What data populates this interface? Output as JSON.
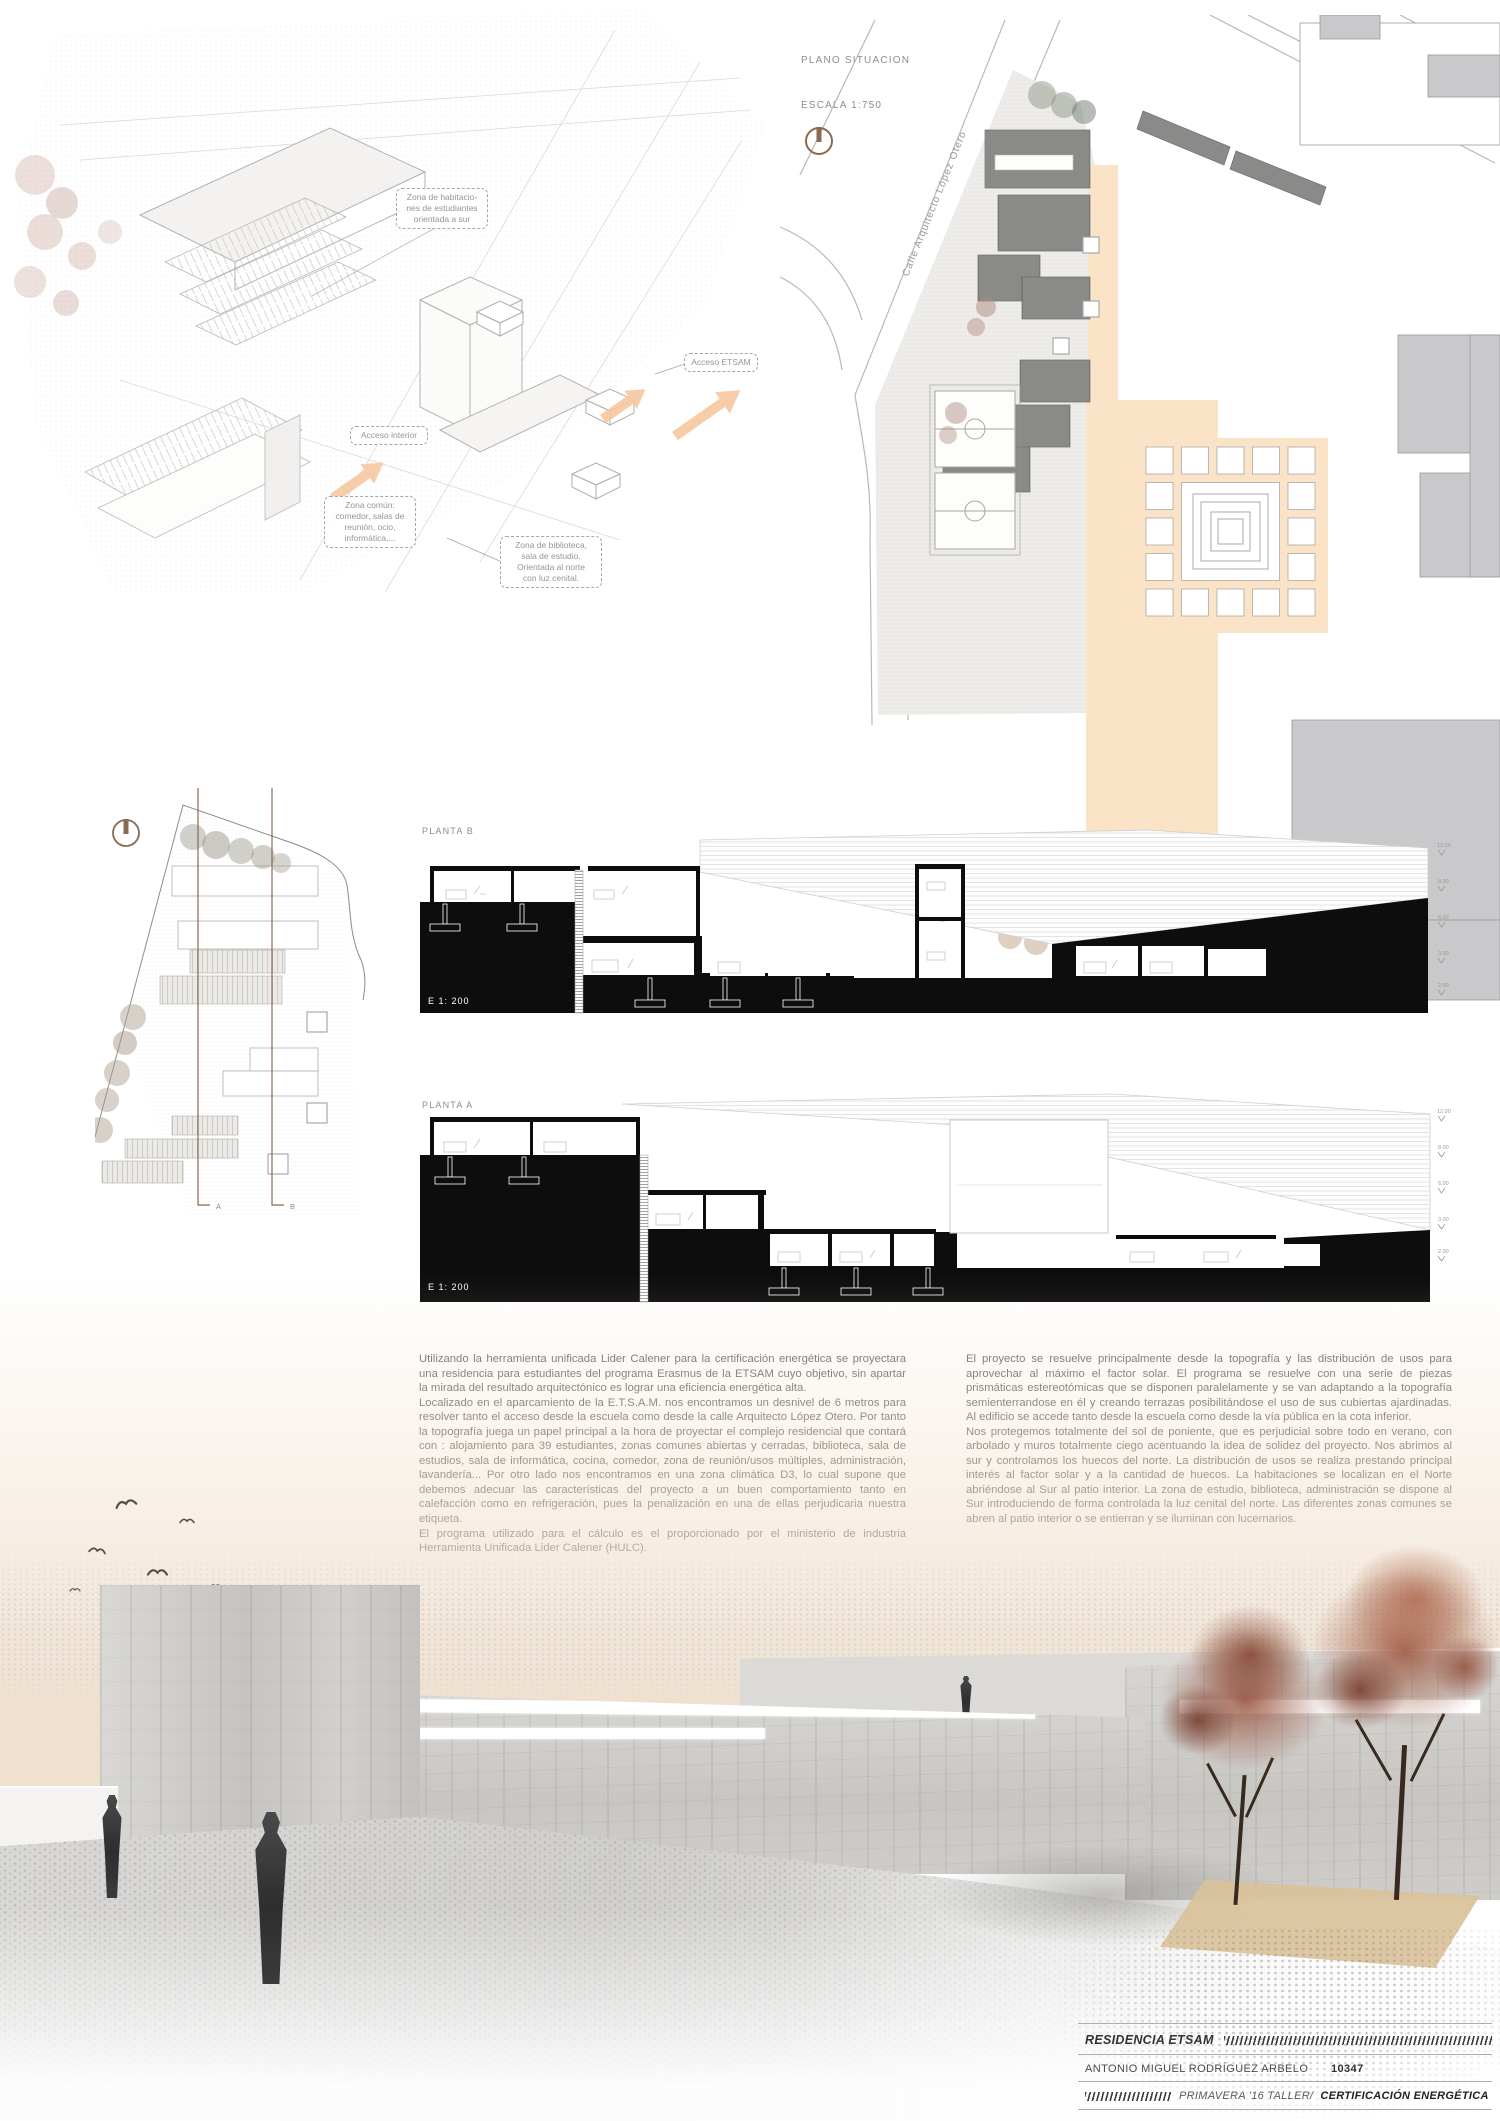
{
  "axon": {
    "annotations": [
      {
        "text": "Zona de habitacio-\nnes de estudiantes\norientada a sur"
      },
      {
        "text": "Acceso ETSAM"
      },
      {
        "text": "Acceso interior"
      },
      {
        "text": "Zona común:\ncomedor, salas de\nreunión, ocio,\ninformática,..."
      },
      {
        "text": "Zona de biblioteca,\nsala de estudio.\nOrientada al norte\ncon luz cenital."
      }
    ]
  },
  "site_plan": {
    "title": "PLANO SITUACION",
    "scale": "ESCALA  1:750",
    "street_label": "Calle Arquitecto López Otero"
  },
  "left_plan": {
    "marker_a": "A",
    "marker_b": "B"
  },
  "sections": {
    "planta_b_label": "PLANTA B",
    "planta_a_label": "PLANTA A",
    "scale_label": "E  1: 200",
    "levels": [
      "12.00",
      "8.00",
      "6.00",
      "3.00",
      "2.00"
    ]
  },
  "text_columns": {
    "left": [
      "Utilizando la herramienta unificada Lider Calener para la certificación energética se proyectara una residencia para estudiantes del programa Erasmus de la ETSAM cuyo objetivo, sin apartar la mirada del resultado arquitectónico es lograr una eficiencia energética alta.",
      "Localizado en el aparcamiento de la E.T.S.A.M. nos encontramos un desnivel de 6 metros para resolver tanto el acceso desde la escuela como desde la calle Arquitecto López Otero. Por tanto la topografía juega un papel principal a la hora de proyectar el complejo residencial que contará con : alojamiento para 39 estudiantes, zonas comunes abiertas y cerradas, biblioteca, sala de estudios, sala de informática, cocina, comedor, zona de reunión/usos múltiples, administración, lavandería... Por otro lado nos encontramos en una zona climática D3, lo cual supone que debemos adecuar las características del proyecto a un buen comportamiento tanto en calefacción como en refrigeración, pues la penalización en una de ellas perjudicaria nuestra etiqueta.",
      "El programa utilizado para el cálculo es el proporcionado por el ministerio de industria Herramienta Unificada Lider Calener (HULC)."
    ],
    "right": [
      "El proyecto se resuelve principalmente desde la topografía y las distribución de usos para aprovechar al máximo el factor solar. El programa se resuelve con una serie de piezas prismáticas estereotómicas que se disponen paralelamente y se van adaptando a la topografía semienterrandose en él y creando terrazas posibilitándose el uso de sus cubiertas ajardinadas. Al edificio se accede tanto desde la escuela como desde la vía pública en la cota inferior.",
      "Nos protegemos totalmente del sol de poniente, que es perjudicial sobre todo en verano, con arbolado y muros totalmente ciego acentuando la idea de solidez del proyecto. Nos abrimos al sur y controlamos los huecos del norte. La distribución de usos se realiza prestando principal interés al factor solar y a la cantidad de huecos. La habitaciones se localizan en el Norte abriéndose al Sur al patio interior. La zona de estudio, biblioteca, administración se dispone al Sur introduciendo de forma controlada la luz cenital del norte. Las diferentes zonas comunes se abren al patio interior o se entierran y se iluminan con lucernarios."
    ]
  },
  "title_block": {
    "project": "RESIDENCIA ETSAM",
    "author": "ANTONIO MIGUEL RODRÍGUEZ ARBELO",
    "number": "10347",
    "term": "PRIMAVERA '16 TALLER/",
    "course": "CERTIFICACIÓN ENERGÉTICA"
  },
  "colors": {
    "accent_peach": "#f9e3c7",
    "accent_brown": "#8a6a50",
    "poche_black": "#0d0d0d",
    "tree_red": "#8f4b38"
  }
}
